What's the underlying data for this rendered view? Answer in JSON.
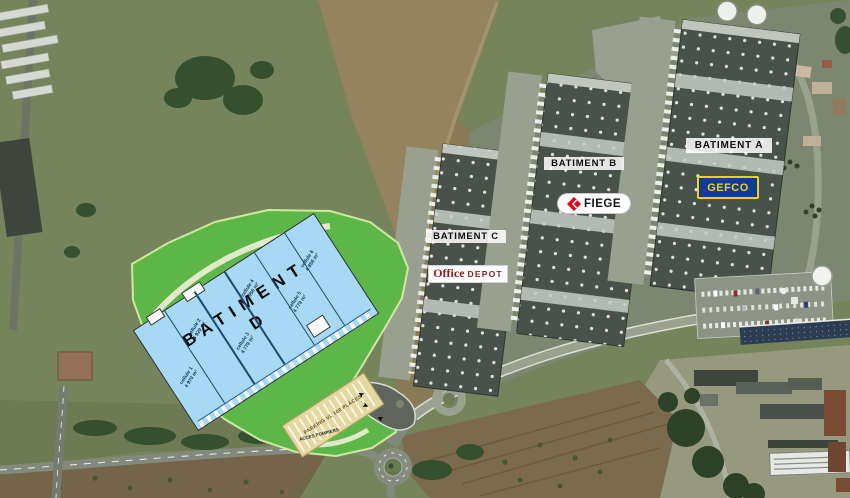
{
  "buildings": {
    "a": {
      "label": "BATIMENT A",
      "tenant": "GEFCO"
    },
    "b": {
      "label": "BATIMENT B",
      "tenant": "FIEGE"
    },
    "c": {
      "label": "BATIMENT C",
      "tenant": "Office DEPOT"
    }
  },
  "logos": {
    "gefco": {
      "text": "GEFCO",
      "bg_color": "#0c3c94",
      "text_color": "#f2cf1c"
    },
    "fiege": {
      "text": "FIEGE",
      "icon": "red-diamond-arrow",
      "icon_color": "#e2001a",
      "text_color": "#151515"
    },
    "office_depot": {
      "word1": "Office",
      "word2": "DEPOT",
      "text_color": "#8a1e1e"
    }
  },
  "batiment_d": {
    "title_line1": "BATIMENT",
    "title_line2": "D",
    "plan_fill_color": "#a7d9f4",
    "landscape_color": "#5cb648",
    "cells": [
      {
        "name": "cellule 1",
        "area": "4 970 m²"
      },
      {
        "name": "cellule 2",
        "area": "4 929 m²"
      },
      {
        "name": "cellule 3",
        "area": "4 779 m²"
      },
      {
        "name": "cellule 4",
        "area": "4 956 m²"
      },
      {
        "name": "cellule 5",
        "area": "4 779 m²"
      },
      {
        "name": "cellule 6",
        "area": "4 856 m²"
      }
    ],
    "parking_label": "PARKING VL 100 PLACES",
    "access_label": "ACCES POMPIERS"
  }
}
